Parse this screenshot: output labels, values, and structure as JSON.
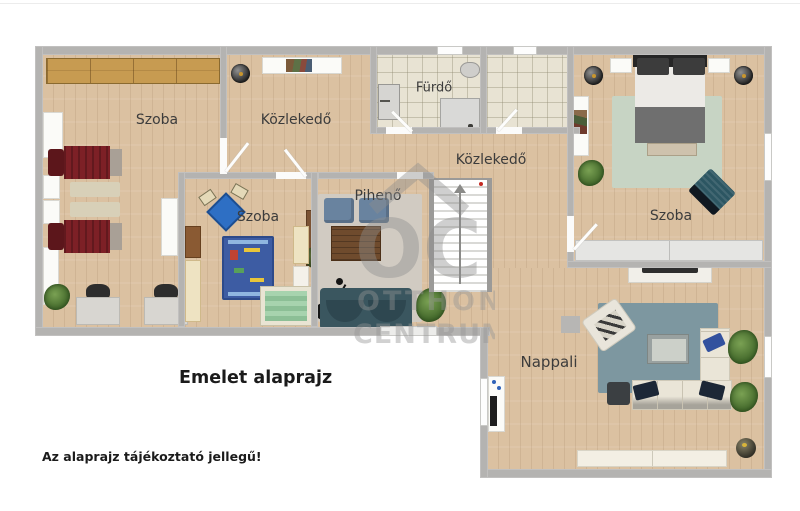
{
  "page": {
    "title": "Emelet alaprajz",
    "disclaimer": "Az alaprajz tájékoztató jellegű!"
  },
  "watermark": {
    "logo": "OC",
    "line1": "OTTHON",
    "line2": "CENTRUM"
  },
  "rooms": [
    {
      "id": "szoba-left",
      "label": "Szoba"
    },
    {
      "id": "kozlekedo-upper",
      "label": "Közlekedő"
    },
    {
      "id": "furdo",
      "label": "Fürdő"
    },
    {
      "id": "kozlekedo-main",
      "label": "Közlekedő"
    },
    {
      "id": "piheno",
      "label": "Pihenő"
    },
    {
      "id": "szoba-middle",
      "label": "Szoba"
    },
    {
      "id": "szoba-right",
      "label": "Szoba"
    },
    {
      "id": "nappali",
      "label": "Nappali"
    }
  ],
  "colors": {
    "wall": "#b4b3b1",
    "wood_floor": "#dbc1a1",
    "tile_floor": "#e8e3d3",
    "red_bed": "#7d2026",
    "teal_sofa": "#3a565f",
    "cream_sofa": "#e9e4d6",
    "kid_rug_blue": "#3d5ca3",
    "sage_rug": "#c7d4c4",
    "living_rug": "#7d97a0",
    "watermark_gray": "#8e8e8e"
  }
}
